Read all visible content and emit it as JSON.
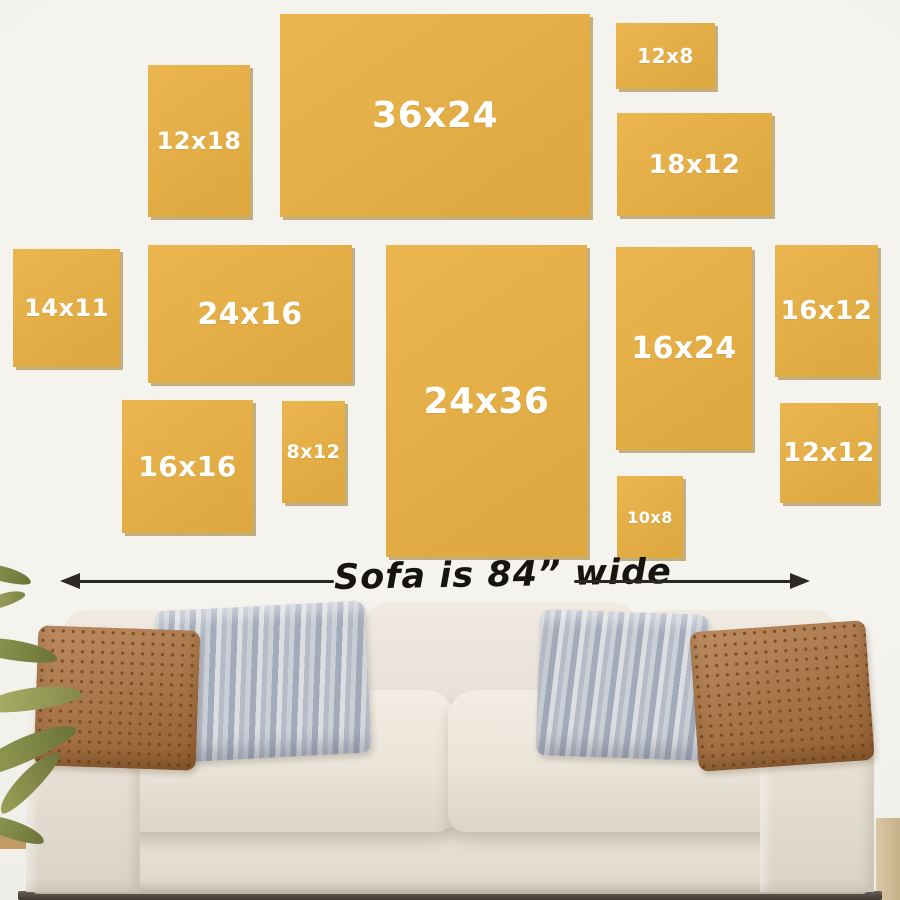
{
  "frames": {
    "color": "#E9B042",
    "shadow_color": "#96762C",
    "label_color": "#FFFFFF",
    "items": [
      {
        "label": "12x18",
        "x": 148,
        "y": 65,
        "w": 102,
        "h": 152,
        "fs": 24
      },
      {
        "label": "36x24",
        "x": 280,
        "y": 14,
        "w": 310,
        "h": 203,
        "fs": 36
      },
      {
        "label": "12x8",
        "x": 616,
        "y": 23,
        "w": 99,
        "h": 66,
        "fs": 20
      },
      {
        "label": "18x12",
        "x": 617,
        "y": 113,
        "w": 155,
        "h": 103,
        "fs": 26
      },
      {
        "label": "14x11",
        "x": 13,
        "y": 249,
        "w": 107,
        "h": 118,
        "fs": 24
      },
      {
        "label": "24x16",
        "x": 148,
        "y": 245,
        "w": 204,
        "h": 138,
        "fs": 30
      },
      {
        "label": "24x36",
        "x": 386,
        "y": 245,
        "w": 201,
        "h": 312,
        "fs": 36
      },
      {
        "label": "16x24",
        "x": 616,
        "y": 247,
        "w": 136,
        "h": 203,
        "fs": 30
      },
      {
        "label": "16x12",
        "x": 775,
        "y": 245,
        "w": 103,
        "h": 132,
        "fs": 26
      },
      {
        "label": "16x16",
        "x": 122,
        "y": 400,
        "w": 131,
        "h": 133,
        "fs": 28
      },
      {
        "label": "8x12",
        "x": 282,
        "y": 401,
        "w": 63,
        "h": 102,
        "fs": 19
      },
      {
        "label": "12x12",
        "x": 780,
        "y": 403,
        "w": 98,
        "h": 100,
        "fs": 26
      },
      {
        "label": "10x8",
        "x": 617,
        "y": 476,
        "w": 66,
        "h": 82,
        "fs": 16
      }
    ]
  },
  "measure": {
    "label": "Sofa is 84” wide",
    "arrow_color": "#2B2822"
  },
  "palette": {
    "wall": "#F1F0EB",
    "sofa_cream": "#E9E3D8",
    "pillow_rust": "#AC6F3A",
    "pillow_gray": "#B5BBC7",
    "plant_green": "#7C8444"
  }
}
